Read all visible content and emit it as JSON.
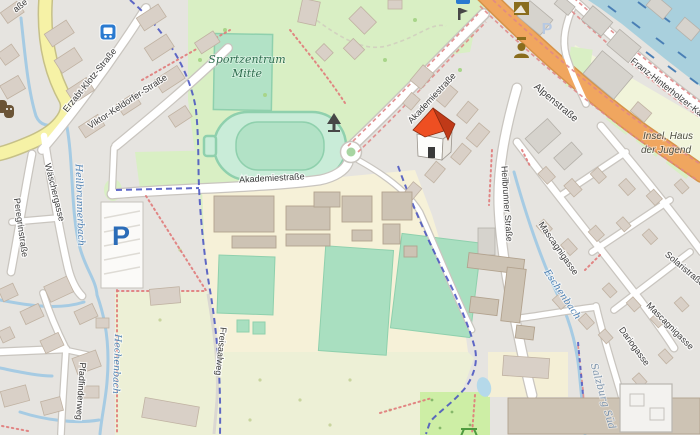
{
  "map": {
    "type": "openstreetmap-slippy-tile-view",
    "labels": {
      "top_partial": "aße",
      "erzabt": "Erzabt-Klotz-Straße",
      "viktor": "Viktor-Keldorfer-Straße",
      "waescher": "Wäschergasse",
      "peregrin": "Peregrinstraße",
      "heilbrunnerbach": "Heilbrunnerbach",
      "sport_line1": "Sportzentrum",
      "sport_line2": "Mitte",
      "akademie_w": "Akademiestraße",
      "akademie_ne": "Akademiestraße",
      "alpen": "Alpenstraße",
      "franz": "Franz-Hinterholzer-Kai",
      "insel_line1": "Insel, Haus",
      "insel_line2": "der Jugend",
      "heilbrunner": "Heilbrunner Straße",
      "mascagni_upper": "Mascagnigasse",
      "mascagni_lower": "Mascagnigasse",
      "solaris": "Solaristraße",
      "dario": "Dariogasse",
      "eschenbach": "Eschenbach",
      "salzburg_sued": "Salzburg Süd",
      "hechenbach": "Hechenbach",
      "freisaal": "Freisaalweg",
      "pfadfinder": "Pfadfinderweg",
      "parking_main": "P",
      "parking_faint": "P"
    },
    "icons": {
      "bus_stop": "bus-stop",
      "theatre_masks": "theatre-masks",
      "artwork": "artwork",
      "memorial_bust": "memorial-bust",
      "house_marker": "red-house-marker",
      "monument": "monument",
      "sculpture": "sculpture",
      "picnic_table": "picnic-table",
      "roundabout": "mini-roundabout"
    },
    "colors": {
      "residential": "#e6e4e0",
      "park": "#d9efc4",
      "farmland": "#edf0d6",
      "campus": "#f6f1d8",
      "pitch": "#a9dfc0",
      "track": "#c9ecd8",
      "water": "#a9d0dd",
      "water_stream": "#a6cbe3",
      "road_primary": "#f0a65f",
      "road_secondary": "#f6f2a6",
      "boundary": "#4450c0",
      "route": "#e08888",
      "building": "#d9d0c7",
      "building_dark": "#cdc3b4",
      "marker_roof": "#e8491f",
      "parking_blue": "#2b6cb8",
      "label": "#3c3c3c",
      "water_label": "#4d80b3",
      "leisure_label": "#2f6e4f"
    }
  }
}
